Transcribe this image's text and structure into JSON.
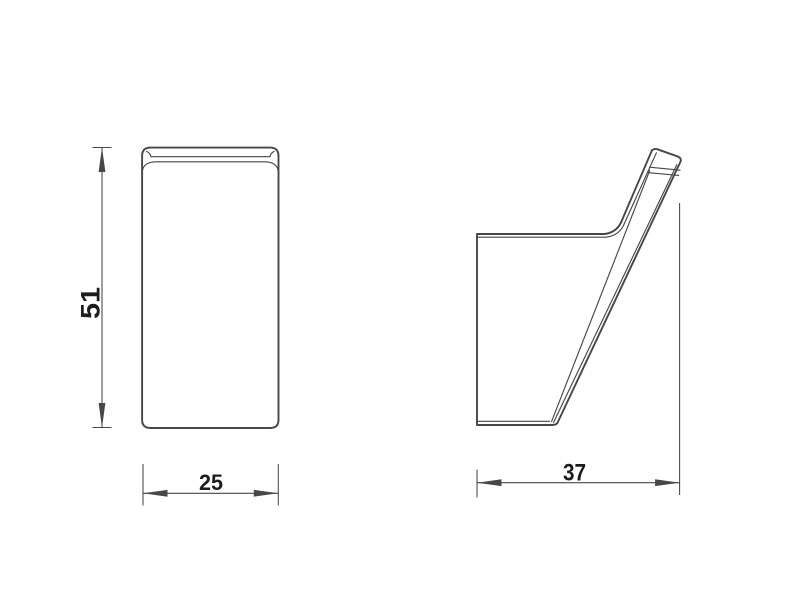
{
  "drawing": {
    "type": "technical-orthographic-drawing",
    "subject": "wall hook, two views (front and side profile)",
    "views": {
      "front": {
        "name": "front-view",
        "height_dim": "51",
        "width_dim": "25"
      },
      "side": {
        "name": "side-profile-view",
        "depth_dim": "37"
      }
    },
    "colors": {
      "line": "#474747",
      "text": "#1d1d1d",
      "background": "#ffffff"
    }
  }
}
